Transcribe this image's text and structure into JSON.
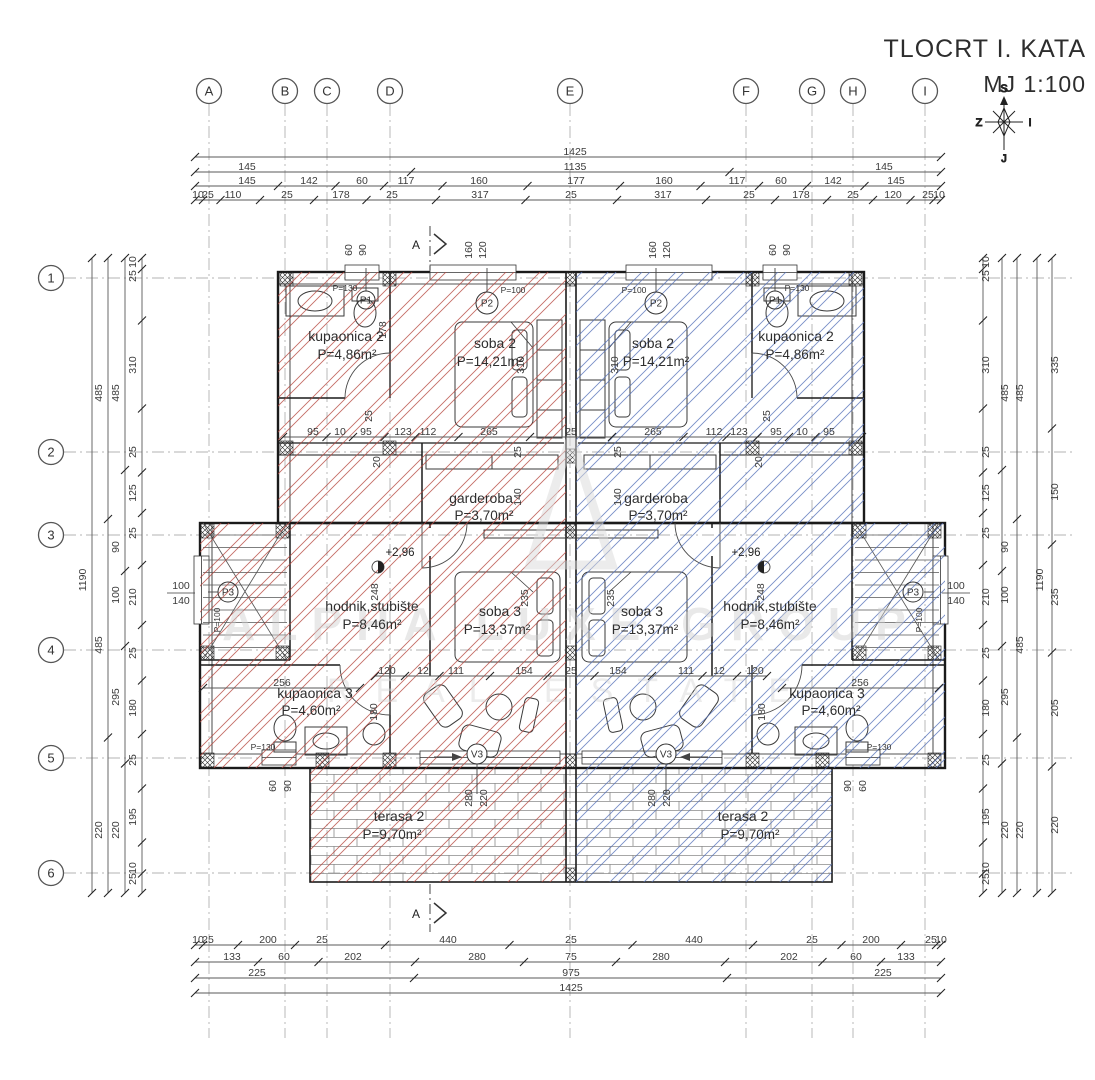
{
  "title": {
    "line1": "TLOCRT I. KATA",
    "line2": "MJ 1:100"
  },
  "compass": {
    "n": "S",
    "w": "Z",
    "e": "I",
    "s": "J"
  },
  "watermark": {
    "line1": "ALPHA LUXE GROUP",
    "line2": "REAL ESTATE"
  },
  "colors": {
    "hatch_left": "#b5473f",
    "hatch_right": "#5571b8",
    "wall": "#1a1a1a",
    "dim_text": "#3b3b3b",
    "grid_line": "#b3b3b3"
  },
  "grid": {
    "cols": [
      {
        "label": "A",
        "x": 209
      },
      {
        "label": "B",
        "x": 285
      },
      {
        "label": "C",
        "x": 327
      },
      {
        "label": "D",
        "x": 390
      },
      {
        "label": "E",
        "x": 570
      },
      {
        "label": "F",
        "x": 746
      },
      {
        "label": "G",
        "x": 812
      },
      {
        "label": "H",
        "x": 853
      },
      {
        "label": "I",
        "x": 925
      }
    ],
    "rows": [
      {
        "label": "1",
        "y": 278
      },
      {
        "label": "2",
        "y": 452
      },
      {
        "label": "3",
        "y": 535
      },
      {
        "label": "4",
        "y": 650
      },
      {
        "label": "5",
        "y": 758
      },
      {
        "label": "6",
        "y": 873
      }
    ]
  },
  "rooms": [
    {
      "name": "kupaonica 2",
      "area": "P=4,86m²",
      "nx": 346,
      "ny": 341,
      "ax": 347,
      "ay": 359
    },
    {
      "name": "soba 2",
      "area": "P=14,21m²",
      "nx": 495,
      "ny": 348,
      "ax": 490,
      "ay": 366
    },
    {
      "name": "soba 2",
      "area": "P=14,21m²",
      "nx": 653,
      "ny": 348,
      "ax": 656,
      "ay": 366
    },
    {
      "name": "kupaonica 2",
      "area": "P=4,86m²",
      "nx": 796,
      "ny": 341,
      "ax": 795,
      "ay": 359
    },
    {
      "name": "garderoba",
      "area": "P=3,70m²",
      "nx": 481,
      "ny": 503,
      "ax": 484,
      "ay": 520
    },
    {
      "name": "garderoba",
      "area": "P=3,70m²",
      "nx": 656,
      "ny": 503,
      "ax": 658,
      "ay": 520
    },
    {
      "name": "hodnik,stubište",
      "area": "P=8,46m²",
      "nx": 372,
      "ny": 611,
      "ax": 372,
      "ay": 629
    },
    {
      "name": "hodnik,stubište",
      "area": "P=8,46m²",
      "nx": 770,
      "ny": 611,
      "ax": 770,
      "ay": 629
    },
    {
      "name": "soba 3",
      "area": "P=13,37m²",
      "nx": 500,
      "ny": 616,
      "ax": 497,
      "ay": 634
    },
    {
      "name": "soba 3",
      "area": "P=13,37m²",
      "nx": 642,
      "ny": 616,
      "ax": 645,
      "ay": 634
    },
    {
      "name": "kupaonica 3",
      "area": "P=4,60m²",
      "nx": 315,
      "ny": 698,
      "ax": 311,
      "ay": 715
    },
    {
      "name": "kupaonica 3",
      "area": "P=4,60m²",
      "nx": 827,
      "ny": 698,
      "ax": 831,
      "ay": 715
    },
    {
      "name": "terasa 2",
      "area": "P=9,70m²",
      "nx": 399,
      "ny": 821,
      "ax": 392,
      "ay": 839
    },
    {
      "name": "terasa 2",
      "area": "P=9,70m²",
      "nx": 743,
      "ny": 821,
      "ax": 750,
      "ay": 839
    }
  ],
  "window_markers": [
    {
      "label": "P1",
      "x": 366,
      "y": 300,
      "r": 9
    },
    {
      "label": "P2",
      "x": 487,
      "y": 303,
      "r": 11
    },
    {
      "label": "P2",
      "x": 656,
      "y": 303,
      "r": 11
    },
    {
      "label": "P1",
      "x": 775,
      "y": 300,
      "r": 9
    },
    {
      "label": "P3",
      "x": 228,
      "y": 592,
      "r": 10
    },
    {
      "label": "P3",
      "x": 913,
      "y": 592,
      "r": 10
    }
  ],
  "parapet_notes": [
    {
      "text": "P=130",
      "x": 345,
      "y": 291
    },
    {
      "text": "P=100",
      "x": 513,
      "y": 293
    },
    {
      "text": "P=100",
      "x": 634,
      "y": 293
    },
    {
      "text": "P=130",
      "x": 797,
      "y": 291
    },
    {
      "text": "P=130",
      "x": 263,
      "y": 750
    },
    {
      "text": "P=130",
      "x": 879,
      "y": 750
    },
    {
      "text": "P=100",
      "x": 220,
      "y": 620,
      "r": 1
    },
    {
      "text": "P=100",
      "x": 922,
      "y": 620,
      "r": 1
    }
  ],
  "door_markers": [
    {
      "label": "V3",
      "x": 477,
      "y": 754,
      "r": 10
    },
    {
      "label": "V3",
      "x": 666,
      "y": 754,
      "r": 10
    }
  ],
  "level_markers": [
    {
      "text": "+2,96",
      "x": 400,
      "y": 556
    },
    {
      "text": "+2,96",
      "x": 746,
      "y": 556
    }
  ],
  "section_markers": [
    {
      "label": "A",
      "x": 420,
      "y": 249
    },
    {
      "label": "A",
      "x": 420,
      "y": 918
    }
  ],
  "stair_labels": [
    {
      "top": "100",
      "bottom": "140",
      "x": 181,
      "y": 592
    },
    {
      "top": "100",
      "bottom": "140",
      "x": 956,
      "y": 592
    }
  ],
  "dims": [
    [
      "1425",
      575,
      153
    ],
    [
      "145",
      247,
      168
    ],
    [
      "1135",
      575,
      168
    ],
    [
      "145",
      884,
      168
    ],
    [
      "145",
      247,
      182
    ],
    [
      "142",
      309,
      182
    ],
    [
      "60",
      362,
      182
    ],
    [
      "117",
      406,
      182
    ],
    [
      "160",
      479,
      182
    ],
    [
      "177",
      576,
      182
    ],
    [
      "160",
      664,
      182
    ],
    [
      "117",
      737,
      182
    ],
    [
      "60",
      781,
      182
    ],
    [
      "142",
      833,
      182
    ],
    [
      "145",
      896,
      182
    ],
    [
      "10",
      198,
      196
    ],
    [
      "25",
      208,
      196
    ],
    [
      "110",
      233,
      196
    ],
    [
      "25",
      287,
      196
    ],
    [
      "178",
      341,
      196
    ],
    [
      "25",
      392,
      196
    ],
    [
      "317",
      480,
      196
    ],
    [
      "25",
      571,
      196
    ],
    [
      "317",
      663,
      196
    ],
    [
      "25",
      749,
      196
    ],
    [
      "178",
      801,
      196
    ],
    [
      "25",
      853,
      196
    ],
    [
      "120",
      893,
      196
    ],
    [
      "25",
      928,
      196
    ],
    [
      "10",
      939,
      196
    ],
    [
      "10",
      198,
      941
    ],
    [
      "25",
      208,
      941
    ],
    [
      "200",
      268,
      941
    ],
    [
      "25",
      322,
      941
    ],
    [
      "440",
      448,
      941
    ],
    [
      "25",
      571,
      941
    ],
    [
      "440",
      694,
      941
    ],
    [
      "25",
      812,
      941
    ],
    [
      "200",
      871,
      941
    ],
    [
      "25",
      931,
      941
    ],
    [
      "10",
      941,
      941
    ],
    [
      "133",
      232,
      958
    ],
    [
      "60",
      284,
      958
    ],
    [
      "202",
      353,
      958
    ],
    [
      "280",
      477,
      958
    ],
    [
      "75",
      571,
      958
    ],
    [
      "280",
      661,
      958
    ],
    [
      "202",
      789,
      958
    ],
    [
      "60",
      856,
      958
    ],
    [
      "133",
      906,
      958
    ],
    [
      "225",
      257,
      974
    ],
    [
      "975",
      571,
      974
    ],
    [
      "225",
      883,
      974
    ],
    [
      "1425",
      571,
      989
    ],
    [
      "1190",
      86,
      580,
      1
    ],
    [
      "485",
      102,
      393,
      1
    ],
    [
      "485",
      102,
      645,
      1
    ],
    [
      "220",
      102,
      830,
      1
    ],
    [
      "485",
      119,
      393,
      1
    ],
    [
      "90",
      119,
      547,
      1
    ],
    [
      "100",
      119,
      595,
      1
    ],
    [
      "295",
      119,
      697,
      1
    ],
    [
      "220",
      119,
      830,
      1
    ],
    [
      "10",
      136,
      262,
      1
    ],
    [
      "25",
      136,
      276,
      1
    ],
    [
      "310",
      136,
      365,
      1
    ],
    [
      "25",
      136,
      452,
      1
    ],
    [
      "125",
      136,
      493,
      1
    ],
    [
      "25",
      136,
      533,
      1
    ],
    [
      "210",
      136,
      597,
      1
    ],
    [
      "25",
      136,
      653,
      1
    ],
    [
      "180",
      136,
      708,
      1
    ],
    [
      "25",
      136,
      760,
      1
    ],
    [
      "195",
      136,
      817,
      1
    ],
    [
      "10",
      136,
      868,
      1
    ],
    [
      "25",
      136,
      879,
      1
    ],
    [
      "10",
      989,
      262,
      1
    ],
    [
      "25",
      989,
      276,
      1
    ],
    [
      "310",
      989,
      365,
      1
    ],
    [
      "25",
      989,
      452,
      1
    ],
    [
      "125",
      989,
      493,
      1
    ],
    [
      "25",
      989,
      533,
      1
    ],
    [
      "210",
      989,
      597,
      1
    ],
    [
      "25",
      989,
      653,
      1
    ],
    [
      "180",
      989,
      708,
      1
    ],
    [
      "25",
      989,
      760,
      1
    ],
    [
      "195",
      989,
      817,
      1
    ],
    [
      "10",
      989,
      868,
      1
    ],
    [
      "25",
      989,
      879,
      1
    ],
    [
      "485",
      1008,
      393,
      1
    ],
    [
      "90",
      1008,
      547,
      1
    ],
    [
      "100",
      1008,
      595,
      1
    ],
    [
      "295",
      1008,
      697,
      1
    ],
    [
      "220",
      1008,
      830,
      1
    ],
    [
      "485",
      1023,
      393,
      1
    ],
    [
      "485",
      1023,
      645,
      1
    ],
    [
      "220",
      1023,
      830,
      1
    ],
    [
      "1190",
      1043,
      580,
      1
    ],
    [
      "335",
      1058,
      365,
      1
    ],
    [
      "150",
      1058,
      492,
      1
    ],
    [
      "235",
      1058,
      597,
      1
    ],
    [
      "205",
      1058,
      708,
      1
    ],
    [
      "220",
      1058,
      825,
      1
    ],
    [
      "95",
      313,
      433
    ],
    [
      "10",
      340,
      433
    ],
    [
      "95",
      366,
      433
    ],
    [
      "123",
      403,
      433
    ],
    [
      "112",
      428,
      433
    ],
    [
      "265",
      489,
      433
    ],
    [
      "25",
      571,
      433
    ],
    [
      "265",
      653,
      433
    ],
    [
      "112",
      714,
      433
    ],
    [
      "123",
      739,
      433
    ],
    [
      "95",
      776,
      433
    ],
    [
      "10",
      802,
      433
    ],
    [
      "95",
      829,
      433
    ],
    [
      "120",
      387,
      672
    ],
    [
      "12",
      423,
      672
    ],
    [
      "111",
      456,
      672
    ],
    [
      "154",
      524,
      672
    ],
    [
      "25",
      571,
      672
    ],
    [
      "154",
      618,
      672
    ],
    [
      "111",
      686,
      672
    ],
    [
      "12",
      719,
      672
    ],
    [
      "120",
      755,
      672
    ],
    [
      "256",
      282,
      684
    ],
    [
      "256",
      860,
      684
    ],
    [
      "178",
      386,
      330,
      1
    ],
    [
      "310",
      524,
      365,
      1
    ],
    [
      "310",
      618,
      365,
      1
    ],
    [
      "248",
      378,
      592,
      1
    ],
    [
      "248",
      764,
      592,
      1
    ],
    [
      "235",
      528,
      598,
      1
    ],
    [
      "235",
      614,
      598,
      1
    ],
    [
      "180",
      377,
      712,
      1
    ],
    [
      "180",
      765,
      712,
      1
    ],
    [
      "60",
      276,
      786,
      1
    ],
    [
      "90",
      291,
      786,
      1
    ],
    [
      "90",
      851,
      786,
      1
    ],
    [
      "60",
      866,
      786,
      1
    ],
    [
      "280",
      472,
      798,
      1
    ],
    [
      "220",
      487,
      798,
      1
    ],
    [
      "280",
      655,
      798,
      1
    ],
    [
      "220",
      670,
      798,
      1
    ],
    [
      "60",
      352,
      250,
      1
    ],
    [
      "90",
      366,
      250,
      1
    ],
    [
      "160",
      472,
      250,
      1
    ],
    [
      "120",
      486,
      250,
      1
    ],
    [
      "160",
      656,
      250,
      1
    ],
    [
      "120",
      670,
      250,
      1
    ],
    [
      "60",
      776,
      250,
      1
    ],
    [
      "90",
      790,
      250,
      1
    ],
    [
      "25",
      521,
      452,
      1
    ],
    [
      "140",
      521,
      497,
      1
    ],
    [
      "25",
      621,
      452,
      1
    ],
    [
      "140",
      621,
      497,
      1
    ],
    [
      "25",
      372,
      416,
      1
    ],
    [
      "20",
      380,
      462,
      1
    ],
    [
      "25",
      770,
      416,
      1
    ],
    [
      "20",
      762,
      462,
      1
    ]
  ],
  "dim_lines": [
    [
      195,
      157,
      941,
      157
    ],
    [
      195,
      172,
      941,
      172
    ],
    [
      195,
      186,
      941,
      186
    ],
    [
      195,
      200,
      941,
      200
    ],
    [
      195,
      945,
      941,
      945
    ],
    [
      195,
      962,
      941,
      962
    ],
    [
      195,
      978,
      941,
      978
    ],
    [
      195,
      993,
      941,
      993
    ],
    [
      283,
      437,
      862,
      437
    ],
    [
      375,
      676,
      767,
      676
    ],
    [
      203,
      688,
      360,
      688
    ],
    [
      782,
      688,
      939,
      688
    ],
    [
      92,
      258,
      92,
      893
    ],
    [
      108,
      258,
      108,
      893
    ],
    [
      125,
      258,
      125,
      893
    ],
    [
      142,
      258,
      142,
      893
    ],
    [
      983,
      258,
      983,
      893
    ],
    [
      1002,
      258,
      1002,
      893
    ],
    [
      1017,
      258,
      1017,
      893
    ],
    [
      1037,
      258,
      1037,
      893
    ],
    [
      1052,
      258,
      1052,
      893
    ]
  ]
}
